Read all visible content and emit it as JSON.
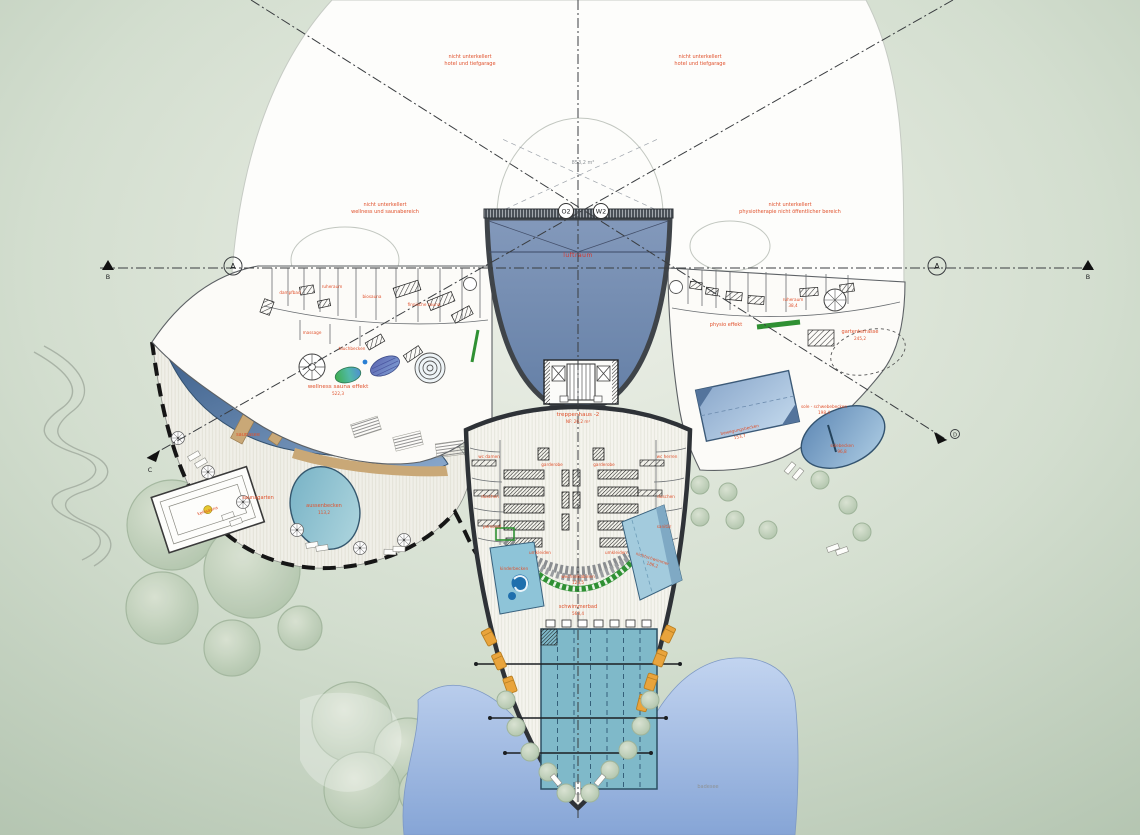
{
  "annotations": {
    "top_left": [
      "nicht unterkellert",
      "hotel und tiefgarage"
    ],
    "top_right": [
      "nicht unterkellert",
      "hotel und tiefgarage"
    ],
    "mid_left": [
      "nicht unterkellert",
      "wellness und saunabereich"
    ],
    "mid_right": [
      "nicht unterkellert",
      "physiotherapie nicht öffentlicher bereich"
    ],
    "hall_area": "853,2 m²",
    "luftraum": "luftraum"
  },
  "markers": {
    "grid_a": "A",
    "grid_b": "B",
    "grid_c": "C",
    "grid_d": "D",
    "axis_o2": "O2",
    "axis_w2": "W2"
  },
  "core": {
    "stair_label": "treppenhaus -2",
    "stair_area": "NF: 26,2 m²"
  },
  "left_wing": {
    "zone_label": "wellness sauna effekt",
    "zone_area": "522,3",
    "rooms": [
      "dampfbad",
      "ruheraum",
      "biosauna",
      "finnische sauna",
      "massage",
      "tauchbecken"
    ]
  },
  "garden": {
    "saunasee": "saunasee",
    "saunagarten": "saunagarten",
    "aussenbecken": "aussenbecken",
    "aussenbecken_area": "113,2",
    "kelosauna": "kelosauna"
  },
  "right_wing": {
    "physio": "physio effekt",
    "ruheraum": "ruheraum",
    "ruheraum_area": "38,4",
    "terrasse": "gartenterrasse",
    "terrasse_area": "245,2",
    "schwebebecken": "sole - schwebebecken",
    "schwebebecken_area": "198,4",
    "bewegungsbecken": "bewegungsbecken",
    "bewegungsbecken_area": "153,7",
    "solebecken": "solebecken",
    "solebecken_area": "96,8"
  },
  "bath_hall": {
    "garderobe_left": "garderobe",
    "garderobe_right": "garderobe",
    "umkleiden_left": "umkleiden",
    "umkleiden_right": "umkleiden",
    "wechselkabinen": "wechselkabinen",
    "wechselkabinen_area": "123,5",
    "kinderbecken": "kinderbecken",
    "nichtschwimmer": "nichtschwimmer",
    "nichtschwimmer_area": "186,2",
    "schwimmerbad": "schwimmerbad",
    "schwimmerbad_area": "563,4",
    "wc_damen": "wc damen",
    "wc_herren": "wc herren",
    "duschen_l": "duschen",
    "duschen_r": "duschen",
    "personal": "personal",
    "sanitaer": "sanitär"
  },
  "site": {
    "badesee": "badesee"
  },
  "colors": {
    "background_edge": "#b4c5b1",
    "background_center": "#edf0e8",
    "accent_orange": "#e0512c",
    "hall_blue_top": "#8399bb",
    "hall_blue_bottom": "#647fa6",
    "pond_dark": "#3f618c",
    "pond_light": "#88a7cb",
    "pool_teal": "#7fb9c9",
    "lake_top": "#c2d4f0",
    "lake_bottom": "#86a5d6",
    "green_band": "#2f9033",
    "lounger_orange": "#e9a43c",
    "tree_green": "#bccdb8",
    "bridge_wood": "#c9a877"
  }
}
